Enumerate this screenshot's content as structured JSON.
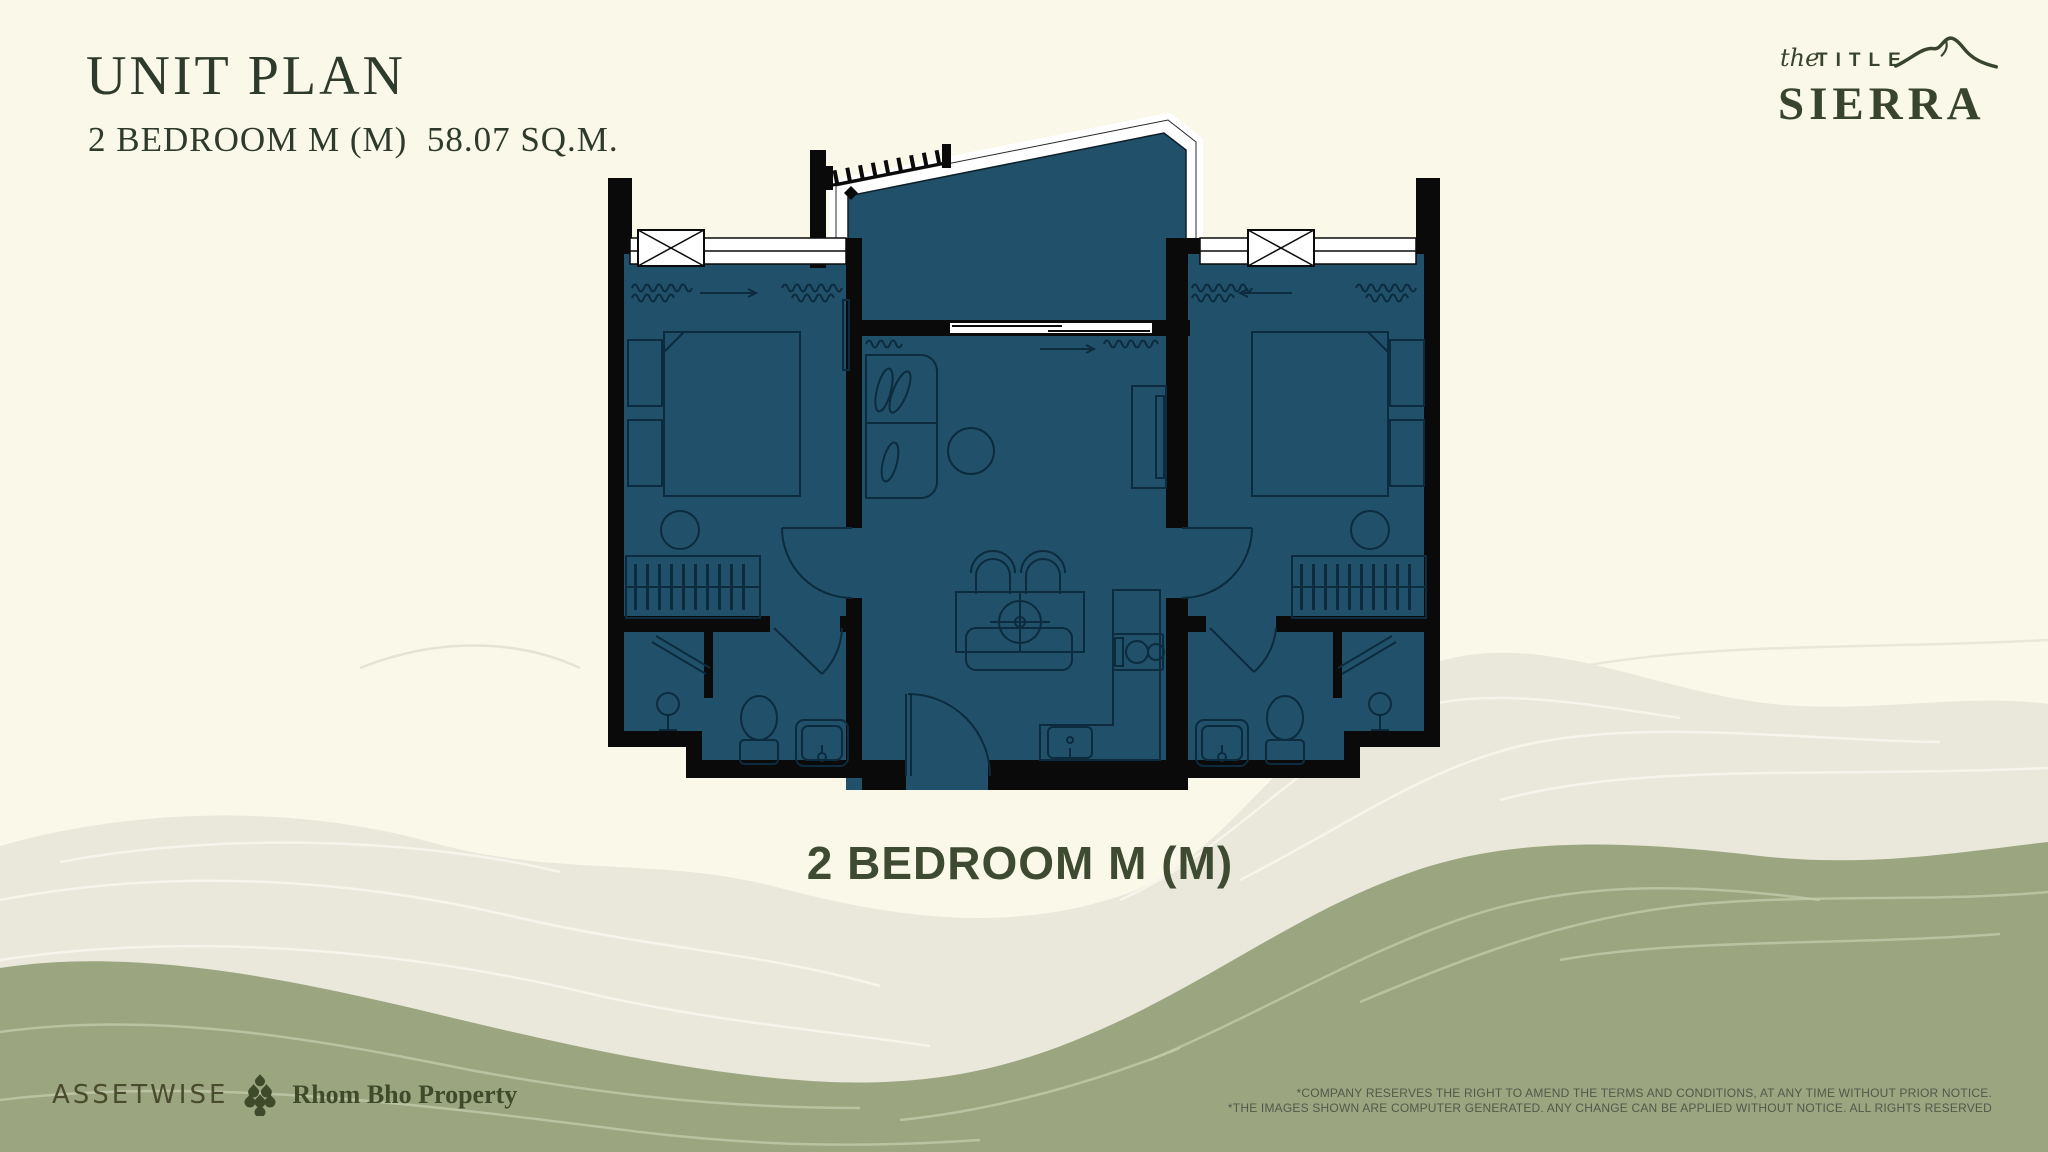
{
  "colors": {
    "page-bg": "#FAF8E9",
    "ink": "#2E3A2B",
    "accent": "#39442E",
    "label": "#3E4A31",
    "plan-fill": "#20506A",
    "plan-line": "#0C2B3E",
    "wall": "#0A0A0A",
    "terr-light": "#E9E8DB",
    "terr-green": "#9BA580",
    "contour-light": "#F7F6EC",
    "contour-green": "#C3C9A9",
    "disclaimer": "#54584A"
  },
  "header": {
    "title": "UNIT PLAN",
    "subtitle": "2 BEDROOM M (M)  58.07 SQ.M."
  },
  "brand": {
    "script": "the",
    "word": "TITLE",
    "name": "SIERRA"
  },
  "plan": {
    "caption": "2 BEDROOM M (M)"
  },
  "footer": {
    "developer": "ASSETWISE",
    "partner": "Rhom Bho Property",
    "disclaimer_line1": "*COMPANY RESERVES THE RIGHT TO AMEND THE TERMS AND CONDITIONS, AT ANY TIME WITHOUT PRIOR NOTICE.",
    "disclaimer_line2": "*THE IMAGES SHOWN ARE COMPUTER GENERATED. ANY CHANGE CAN BE APPLIED WITHOUT NOTICE. ALL RIGHTS RESERVED"
  }
}
